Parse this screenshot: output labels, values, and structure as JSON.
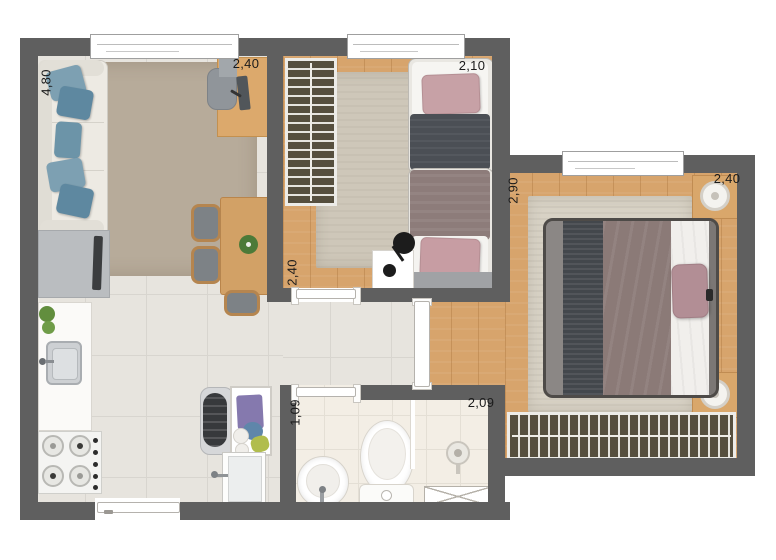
{
  "plan": {
    "type": "apartment-floor-plan",
    "dimensions": {
      "living_width": "4,80",
      "living_depth": "2,40",
      "bedroom2_width": "2,10",
      "bedroom2_depth": "2,40",
      "master_depth": "2,90",
      "master_width": "2,40",
      "bathroom_width": "1,09",
      "bathroom_length": "2,09"
    },
    "colors": {
      "wall": "#5f5f5f",
      "wood_floor": "#d7a46c",
      "tile_floor": "#e7e4de",
      "bathroom_floor": "#f3eee5",
      "living_rug": "#b7ab9a",
      "bedroom_rug": "#cec7b9",
      "master_rug": "#d8d2c5",
      "wardrobe": "#564f3e",
      "pillow_blue": "#6c94a8",
      "pillow_pink": "#c7a1a6",
      "blanket_dark": "#4b4f55",
      "blanket_mauve": "#8d7c7a"
    }
  }
}
